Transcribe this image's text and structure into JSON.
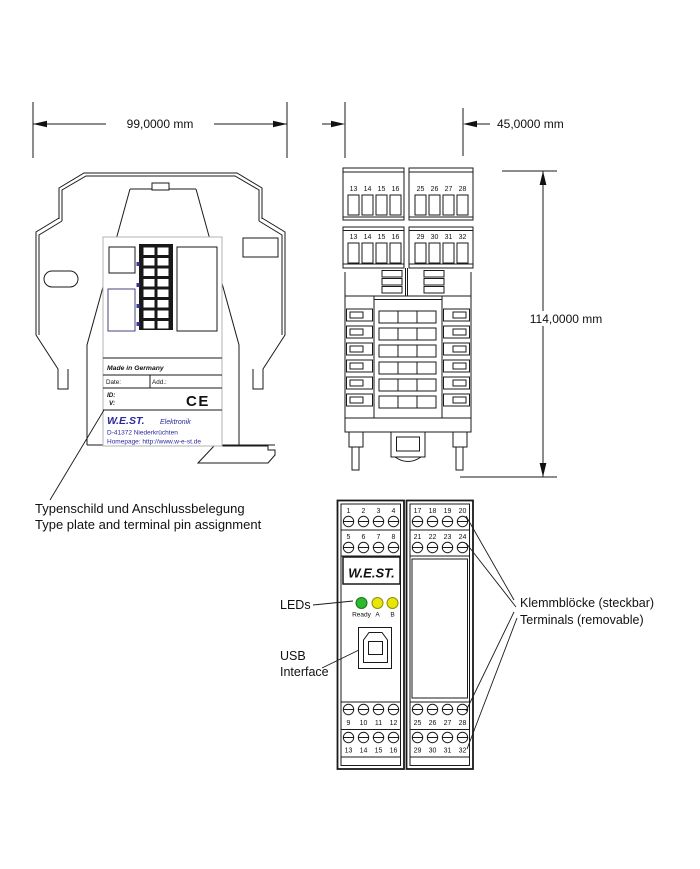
{
  "dimensions": {
    "width": "99,0000 mm",
    "depth": "45,0000 mm",
    "height": "114,0000 mm"
  },
  "labels": {
    "type_plate_de": "Typenschild und Anschlussbelegung",
    "type_plate_en": "Type plate and terminal pin assignment",
    "leds": "LEDs",
    "usb_line1": "USB",
    "usb_line2": "Interface",
    "terminals_de": "Klemmblöcke (steckbar)",
    "terminals_en": "Terminals (removable)"
  },
  "side_view": {
    "type_plate": {
      "made_in": "Made in Germany",
      "date_label": "Date:",
      "add_label": "Add.:",
      "id_label": "ID:",
      "v_label": "V:",
      "ce_mark": "CE",
      "brand": "W.E.ST.",
      "brand_suffix": "Elektronik",
      "address": "D-41372 Niederkrüchten",
      "homepage": "Homepage: http://www.w-e-st.de"
    }
  },
  "top_view": {
    "upper": {
      "left": [
        "13",
        "14",
        "15",
        "16"
      ],
      "right": [
        "25",
        "26",
        "27",
        "28"
      ]
    },
    "lower": {
      "left": [
        "13",
        "14",
        "15",
        "16"
      ],
      "right": [
        "29",
        "30",
        "31",
        "32"
      ]
    }
  },
  "front_view": {
    "logo": "W.E.ST.",
    "leds": {
      "ready": "Ready",
      "a": "A",
      "b": "B"
    },
    "terminals": {
      "top_left": {
        "row1": [
          "1",
          "2",
          "3",
          "4"
        ],
        "row2": [
          "5",
          "6",
          "7",
          "8"
        ]
      },
      "top_right": {
        "row1": [
          "17",
          "18",
          "19",
          "20"
        ],
        "row2": [
          "21",
          "22",
          "23",
          "24"
        ]
      },
      "bottom_left": {
        "row1": [
          "9",
          "10",
          "11",
          "12"
        ],
        "row2": [
          "13",
          "14",
          "15",
          "16"
        ]
      },
      "bottom_right": {
        "row1": [
          "25",
          "26",
          "27",
          "28"
        ],
        "row2": [
          "29",
          "30",
          "31",
          "32"
        ]
      }
    }
  },
  "colors": {
    "line": "#1a1a1a",
    "brand_blue": "#2a2a9c",
    "led_green": "#2eb82e",
    "led_yellow": "#e6e60a",
    "panel_border_gray": "#b3b3b3"
  }
}
